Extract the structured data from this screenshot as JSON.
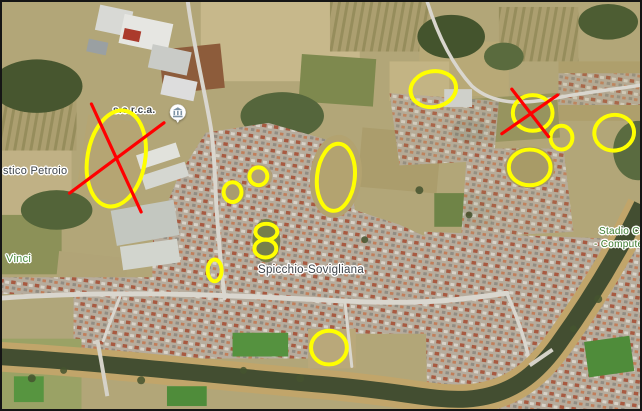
{
  "figure": {
    "kind": "annotated-satellite-map",
    "border_color": "#151515",
    "imagery": "aerial"
  },
  "map": {
    "labels": [
      {
        "id": "serca",
        "text": "s.e.r.c.a.",
        "x": 111,
        "y": 104,
        "size": 10,
        "bold": true,
        "color": "#3d4349"
      },
      {
        "id": "petroio",
        "text": "stico Petroio",
        "x": 1,
        "y": 164,
        "size": 11,
        "bold": false,
        "color": "#3d4349"
      },
      {
        "id": "vinci",
        "text": "Vinci",
        "x": 4,
        "y": 252,
        "size": 11,
        "bold": false,
        "color": "#4a8b3d"
      },
      {
        "id": "spicchio",
        "text": "Spicchio-Sovigliana",
        "x": 256,
        "y": 262,
        "size": 11.5,
        "bold": false,
        "color": "#3d4349"
      },
      {
        "id": "stadio-line1",
        "text": "Stadio Ca",
        "x": 597,
        "y": 225,
        "size": 10,
        "bold": false,
        "color": "#3e7d31"
      },
      {
        "id": "stadio-line2",
        "text": "- Compute",
        "x": 592,
        "y": 238,
        "size": 10,
        "bold": false,
        "color": "#3e7d31"
      }
    ],
    "poi": {
      "icon": "museum-building-icon",
      "x": 176,
      "y": 112
    }
  },
  "annotations": {
    "ellipse_color": "#ffff00",
    "ellipse_stroke_width": 4,
    "cross_color": "#ff0000",
    "cross_stroke_width": 3.2,
    "ellipses": [
      {
        "cx": 115,
        "cy": 158,
        "rx": 29,
        "ry": 49,
        "rot": 10
      },
      {
        "cx": 434,
        "cy": 88,
        "rx": 23,
        "ry": 18,
        "rot": -10
      },
      {
        "cx": 534,
        "cy": 112,
        "rx": 20,
        "ry": 18,
        "rot": 0
      },
      {
        "cx": 563,
        "cy": 137,
        "rx": 11,
        "ry": 12,
        "rot": 0
      },
      {
        "cx": 616,
        "cy": 132,
        "rx": 20,
        "ry": 18,
        "rot": -8
      },
      {
        "cx": 531,
        "cy": 167,
        "rx": 21,
        "ry": 18,
        "rot": 0
      },
      {
        "cx": 336,
        "cy": 177,
        "rx": 19,
        "ry": 34,
        "rot": 6
      },
      {
        "cx": 258,
        "cy": 176,
        "rx": 9,
        "ry": 9,
        "rot": 0
      },
      {
        "cx": 232,
        "cy": 192,
        "rx": 9,
        "ry": 10,
        "rot": 0
      },
      {
        "cx": 266,
        "cy": 232,
        "rx": 11,
        "ry": 8,
        "rot": 0
      },
      {
        "cx": 265,
        "cy": 249,
        "rx": 11,
        "ry": 9,
        "rot": 0
      },
      {
        "cx": 214,
        "cy": 271,
        "rx": 7,
        "ry": 11,
        "rot": 0
      },
      {
        "cx": 329,
        "cy": 349,
        "rx": 18,
        "ry": 17,
        "rot": 0
      }
    ],
    "crosses": [
      {
        "lines": [
          [
            90,
            103,
            140,
            212
          ],
          [
            68,
            193,
            163,
            122
          ]
        ]
      },
      {
        "lines": [
          [
            513,
            88,
            550,
            136
          ],
          [
            559,
            94,
            503,
            133
          ]
        ]
      }
    ]
  }
}
